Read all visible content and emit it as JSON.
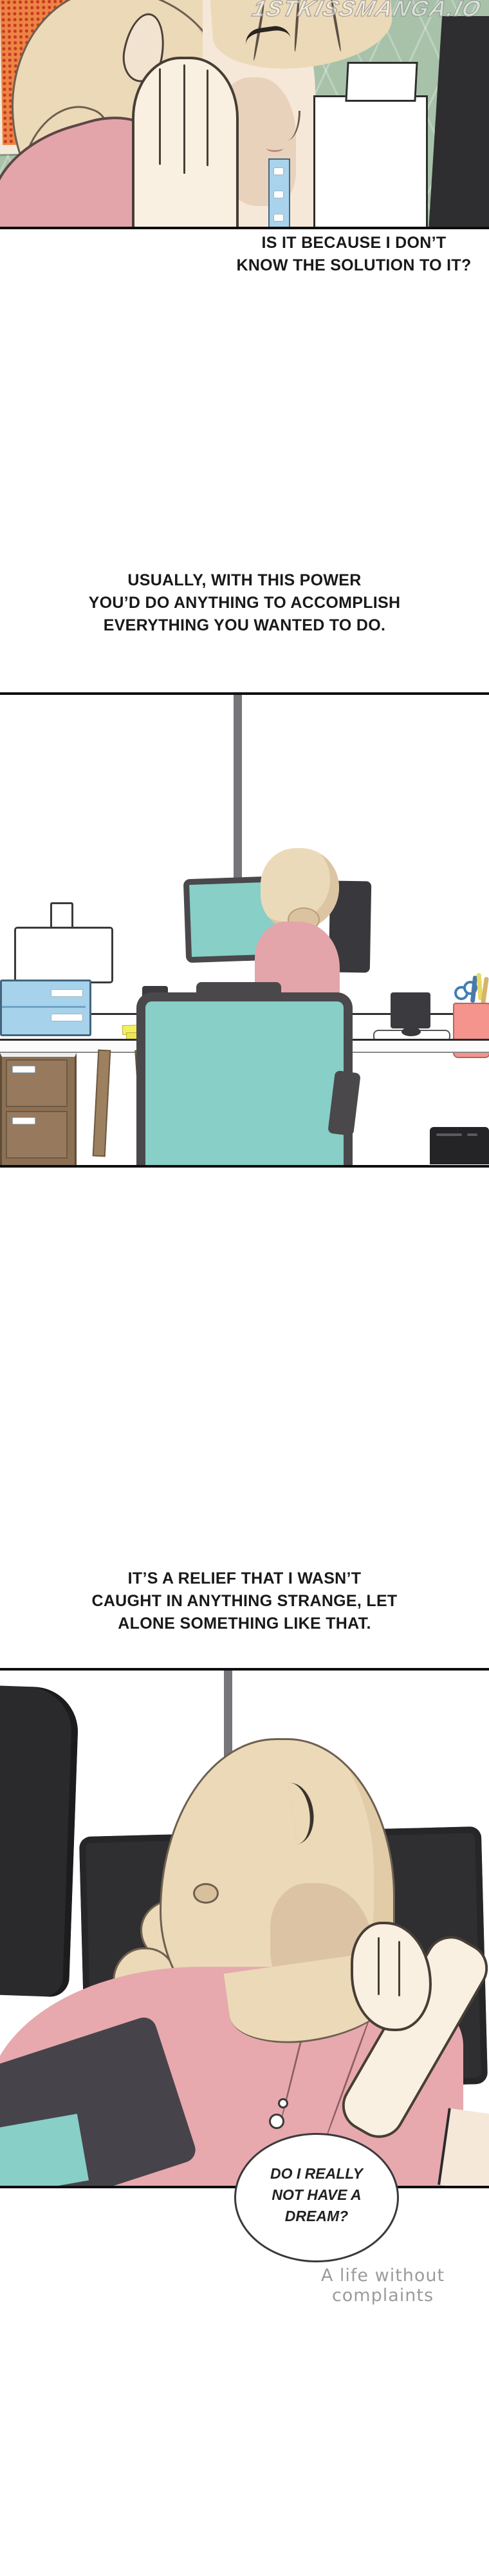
{
  "comic": {
    "watermark": "1STKISSMANGA.IO",
    "narrations": {
      "n1": {
        "line1": "IS IT BECAUSE I DON’T",
        "line2": "KNOW THE SOLUTION TO IT?"
      },
      "n2": {
        "line1": "USUALLY, WITH THIS POWER",
        "line2": "YOU’D DO ANYTHING TO ACCOMPLISH",
        "line3": "EVERYTHING YOU WANTED TO DO."
      },
      "n3": {
        "line1": "IT’S A RELIEF THAT I WASN’T",
        "line2": "CAUGHT IN ANYTHING STRANGE, LET",
        "line3": "ALONE SOMETHING LIKE THAT."
      }
    },
    "thought_bubble": {
      "line1": "DO I REALLY",
      "line2": "NOT HAVE A",
      "line3": "DREAM?"
    },
    "caption": "A life without complaints",
    "colors": {
      "teal_chair": "#87CFC7",
      "pink_shirt": "#E5A8AD",
      "hair_blonde": "#EBD9B8",
      "skin": "#F6E8D8",
      "wall_green": "#A8C2AA",
      "drawer_blue": "#A6D2EB",
      "wood_brown": "#8C7054",
      "sticky_yellow": "#F3EF60",
      "cup_coral": "#F4948C",
      "monitor_dark": "#2F2E31",
      "caption_gray": "#9B9B9B",
      "panel_border": "#0E0E0E"
    }
  }
}
